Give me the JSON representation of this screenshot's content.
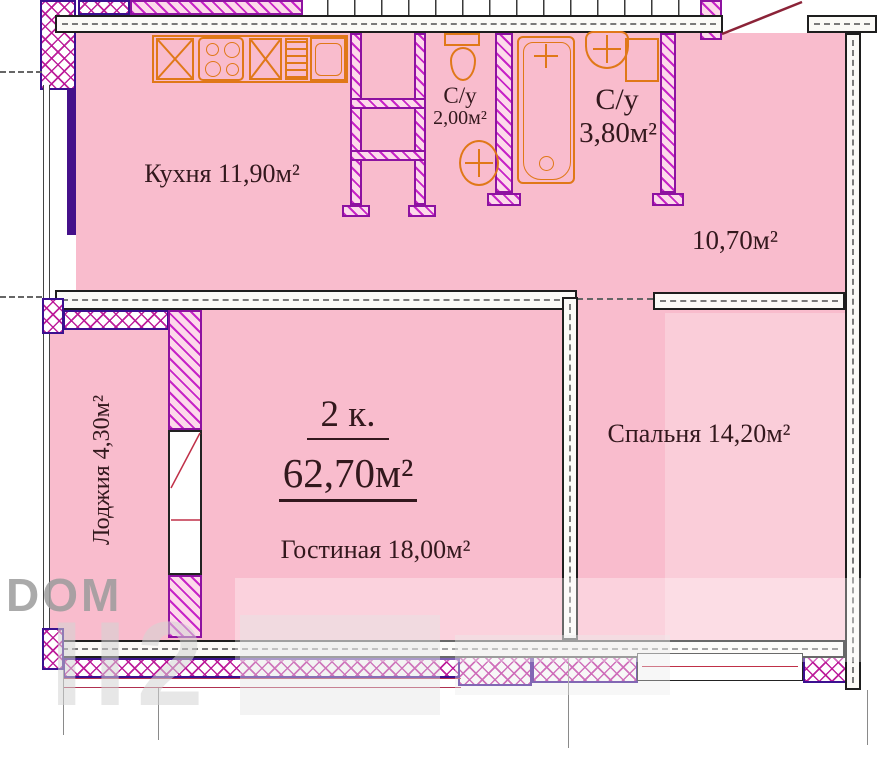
{
  "title": {
    "type_label": "2 к.",
    "total_area": "62,70м²"
  },
  "rooms": {
    "kitchen": {
      "label": "Кухня 11,90м²"
    },
    "bath_small": {
      "name": "С/у",
      "area": "2,00м²"
    },
    "bath_large": {
      "name": "С/у",
      "area": "3,80м²"
    },
    "hallway": {
      "area": "10,70м²"
    },
    "living": {
      "label": "Гостиная 18,00м²"
    },
    "bedroom": {
      "label": "Спальня 14,20м²"
    },
    "loggia": {
      "label": "Лоджия 4,30м²"
    }
  },
  "watermark": {
    "brand": "DOM",
    "large": "ІІ2"
  },
  "colors": {
    "room_fill": "#f9bccd",
    "wall_hatch": "#c724c7",
    "crosshatch_border": "#3c1090",
    "fixture": "#e07818",
    "text": "#33181d",
    "door_swing": "#8b2338"
  }
}
